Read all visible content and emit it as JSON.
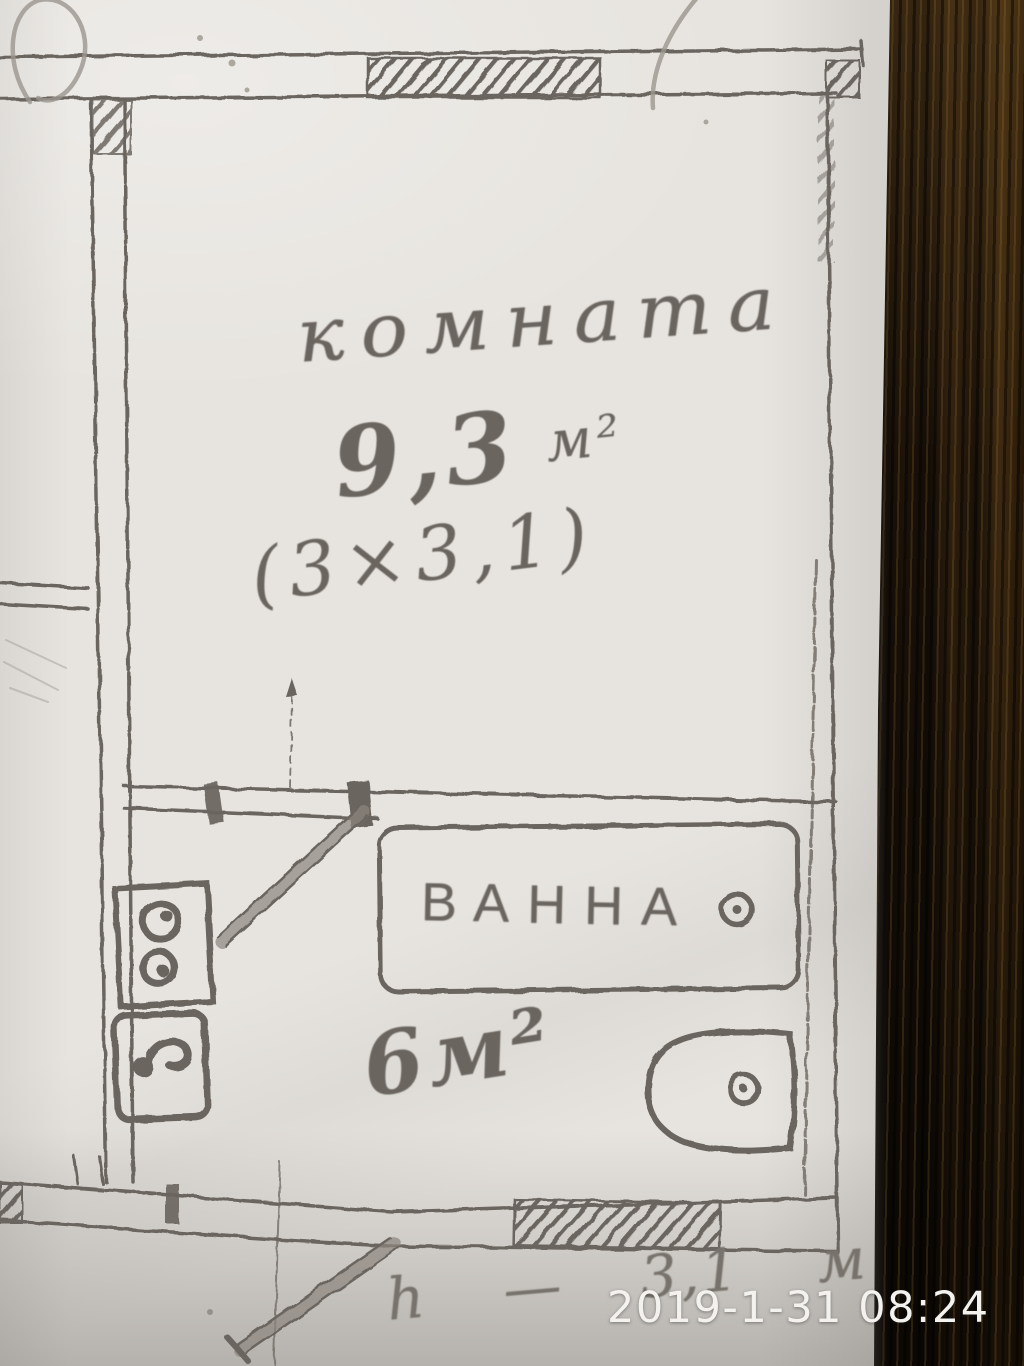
{
  "photo": {
    "timestamp": "2019-1-31 08:24",
    "background": "dark wood table to the right of the paper"
  },
  "plan": {
    "room": {
      "label": "комната",
      "area_value": "9,3",
      "area_unit": "м²",
      "dimensions": "(3×3,1)"
    },
    "bathroom": {
      "bathtub_label": "ВАННА",
      "area": "6м²"
    },
    "height_note": "h — 3,1 м"
  },
  "icons": {
    "bathtub": "rounded-rectangle-with-drain-circle",
    "washbasin": "d-shape-with-drain-circle",
    "stove": "rectangle-with-two-burner-circles",
    "sink": "rounded-rectangle-with-faucet-comma",
    "door_swing": "thick-diagonal-stroke",
    "wall_hatch": "diagonal-hatching"
  },
  "colors": {
    "ink": "#6b655f",
    "pencil": "#9b968e",
    "paper": "#e7e4df",
    "paper_shadow_band": "#c9c6c1",
    "wood_dark": "#17100a",
    "wood_light_streak": "#3e2a11",
    "timestamp_text": "#f3f2ef"
  }
}
